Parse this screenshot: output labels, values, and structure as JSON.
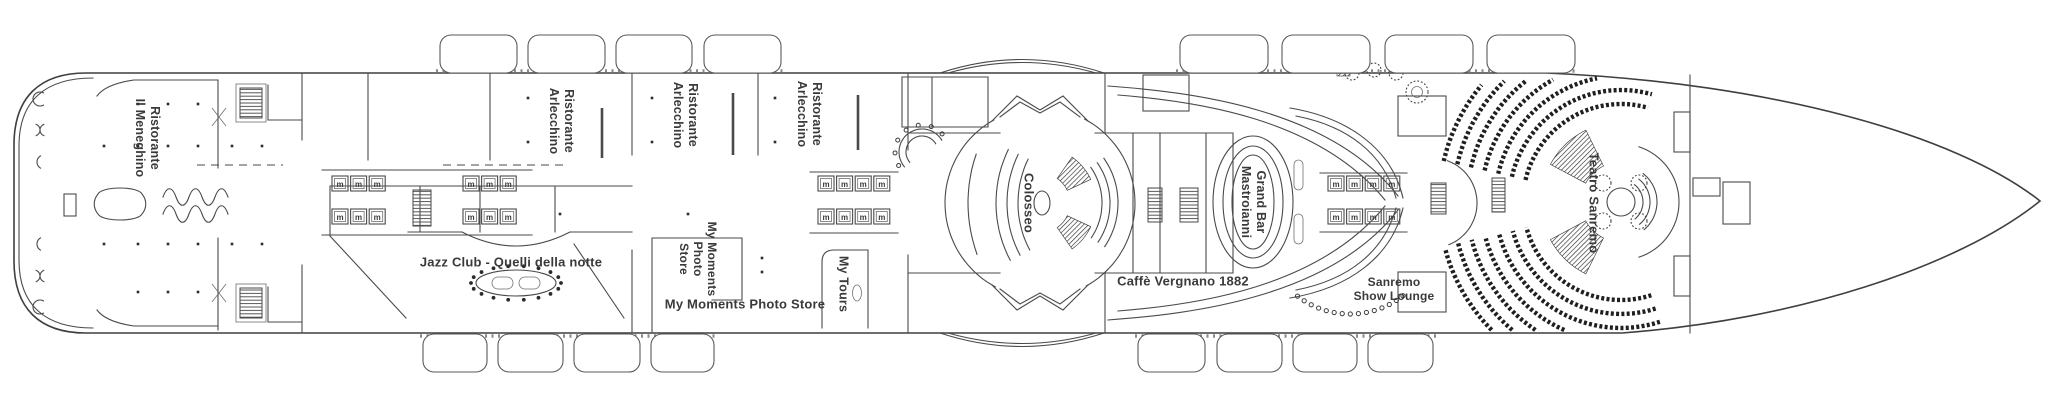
{
  "page": {
    "background": "#ffffff",
    "line_color": "#4a4a4a",
    "seat_color": "#1f1f1f"
  },
  "deck_plan": {
    "labels": {
      "ristorante_il_meneghino": {
        "line1": "Ristorante",
        "line2": "Il Meneghino"
      },
      "ristorante_arlecchino": {
        "line1": "Ristorante",
        "line2": "Arlecchino"
      },
      "jazz_club": "Jazz Club - Quelli della notte",
      "my_moments_photo_store_vertical": {
        "line1": "My Moments",
        "line2": "Photo",
        "line3": "Store"
      },
      "my_moments_photo_store": "My Moments Photo Store",
      "my_tours": "My Tours",
      "colosseo": "Colosseo",
      "grand_bar_mastroianni": {
        "line1": "Grand Bar",
        "line2": "Mastroianni"
      },
      "caffe_vergnano": "Caffè Vergnano 1882",
      "sanremo_show_lounge": {
        "line1": "Sanremo",
        "line2": "Show Lounge"
      },
      "teatro_sanremo": "Teatro Sanremo"
    },
    "icons": {
      "elevator_glyph": "m"
    }
  }
}
